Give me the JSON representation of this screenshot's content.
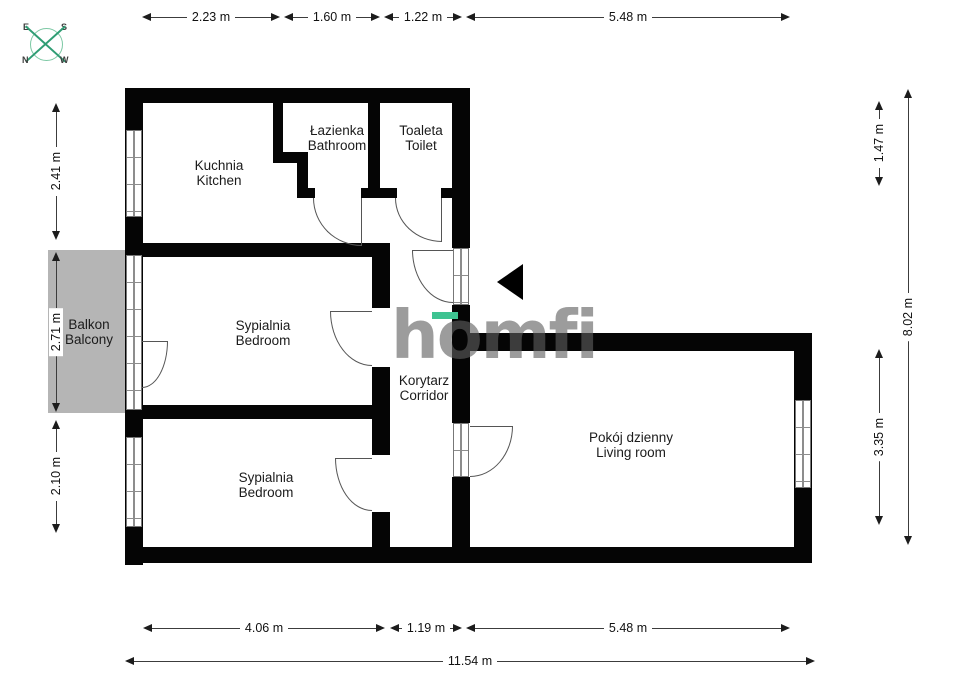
{
  "plan_title": "apartment floor plan",
  "logo": {
    "text": "homfi"
  },
  "compass": {
    "top_left": "E",
    "top_right": "S",
    "bottom_left": "N",
    "bottom_right": "W"
  },
  "rooms": {
    "kitchen": {
      "pl": "Kuchnia",
      "en": "Kitchen"
    },
    "bathroom": {
      "pl": "Łazienka",
      "en": "Bathroom"
    },
    "toilet": {
      "pl": "Toaleta",
      "en": "Toilet"
    },
    "bedroom1": {
      "pl": "Sypialnia",
      "en": "Bedroom"
    },
    "bedroom2": {
      "pl": "Sypialnia",
      "en": "Bedroom"
    },
    "corridor": {
      "pl": "Korytarz",
      "en": "Corridor"
    },
    "living": {
      "pl": "Pokój dzienny",
      "en": "Living room"
    },
    "balcony": {
      "pl": "Balkon",
      "en": "Balcony"
    }
  },
  "dims": {
    "top": [
      "2.23 m",
      "1.60 m",
      "1.22 m",
      "5.48 m"
    ],
    "bottom": [
      "4.06 m",
      "1.19 m",
      "5.48 m"
    ],
    "total_width": "11.54 m",
    "left": [
      "2.41 m",
      "2.71 m",
      "2.10 m"
    ],
    "right": [
      "1.47 m",
      "8.02 m",
      "3.35 m"
    ]
  },
  "colors": {
    "wall": "#050505",
    "balcony_fill": "#b5b5b5",
    "compass_green": "#2f9d74",
    "logo_gray": "#9e9e9e",
    "logo_accent": "#3ec391",
    "dimension_line": "#3c3c3c"
  }
}
